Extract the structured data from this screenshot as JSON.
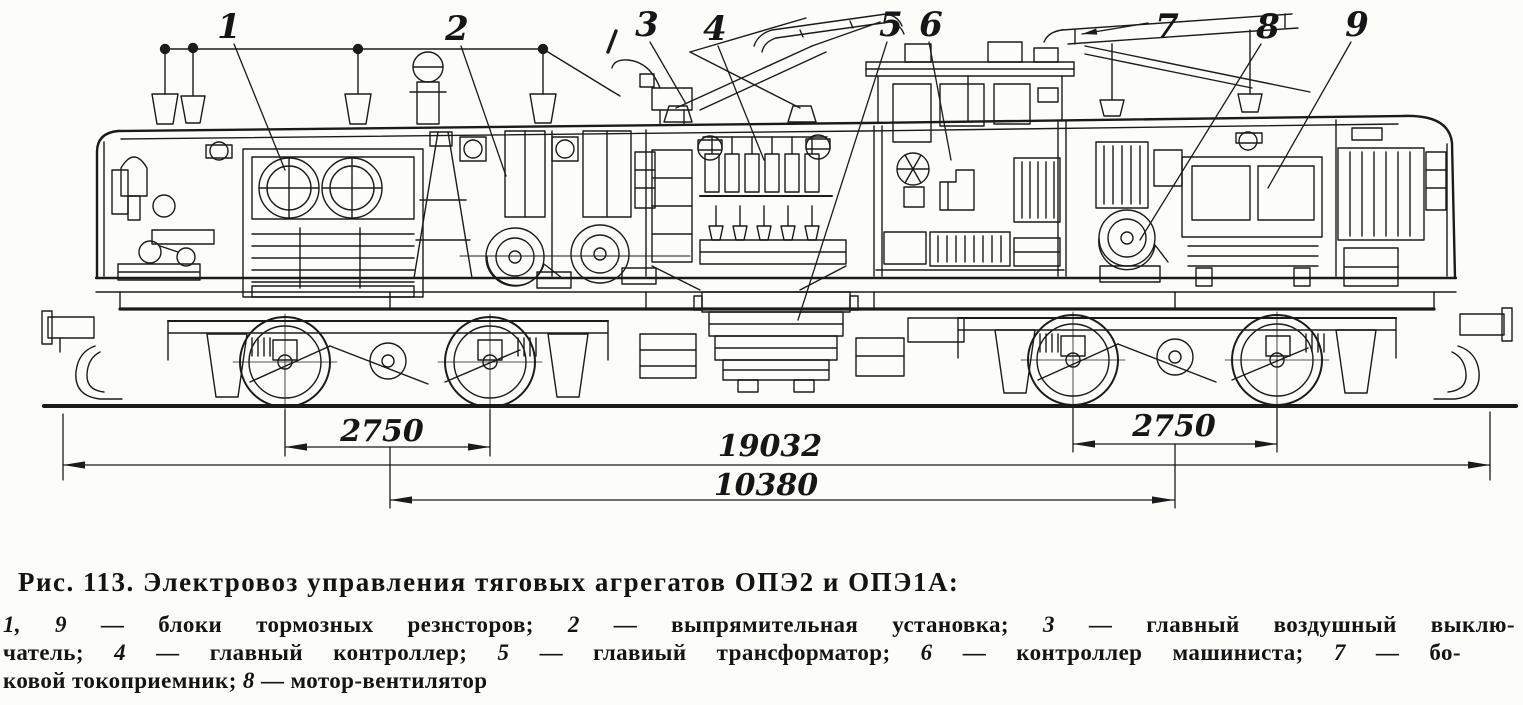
{
  "caption": {
    "heading": "Рис. 113. Электровоз управления тяговых агрегатов ОПЭ2 и ОПЭ1А:",
    "line2": [
      "1, 9",
      " — блоки тормозных резнсторов; ",
      "2",
      " — выпрямительная установка; ",
      "3",
      " — главный воздушный выклю-"
    ],
    "line3": [
      "чатель; ",
      "4",
      " — главный контроллер; ",
      "5",
      " — главиый трансформатор; ",
      "6",
      " — контроллер машиниста; ",
      "7",
      " — бо-"
    ],
    "line4": [
      "ковой токоприемник; ",
      "8",
      " — мотор-вентилятор"
    ]
  },
  "callouts": [
    "1",
    "2",
    "3",
    "4",
    "5",
    "6",
    "7",
    "8",
    "9"
  ],
  "dimensions": {
    "left_wheelbase": "2750",
    "right_wheelbase": "2750",
    "overall_length": "19032",
    "bogie_centers": "10380"
  },
  "ink_color": "#1b1b1b"
}
